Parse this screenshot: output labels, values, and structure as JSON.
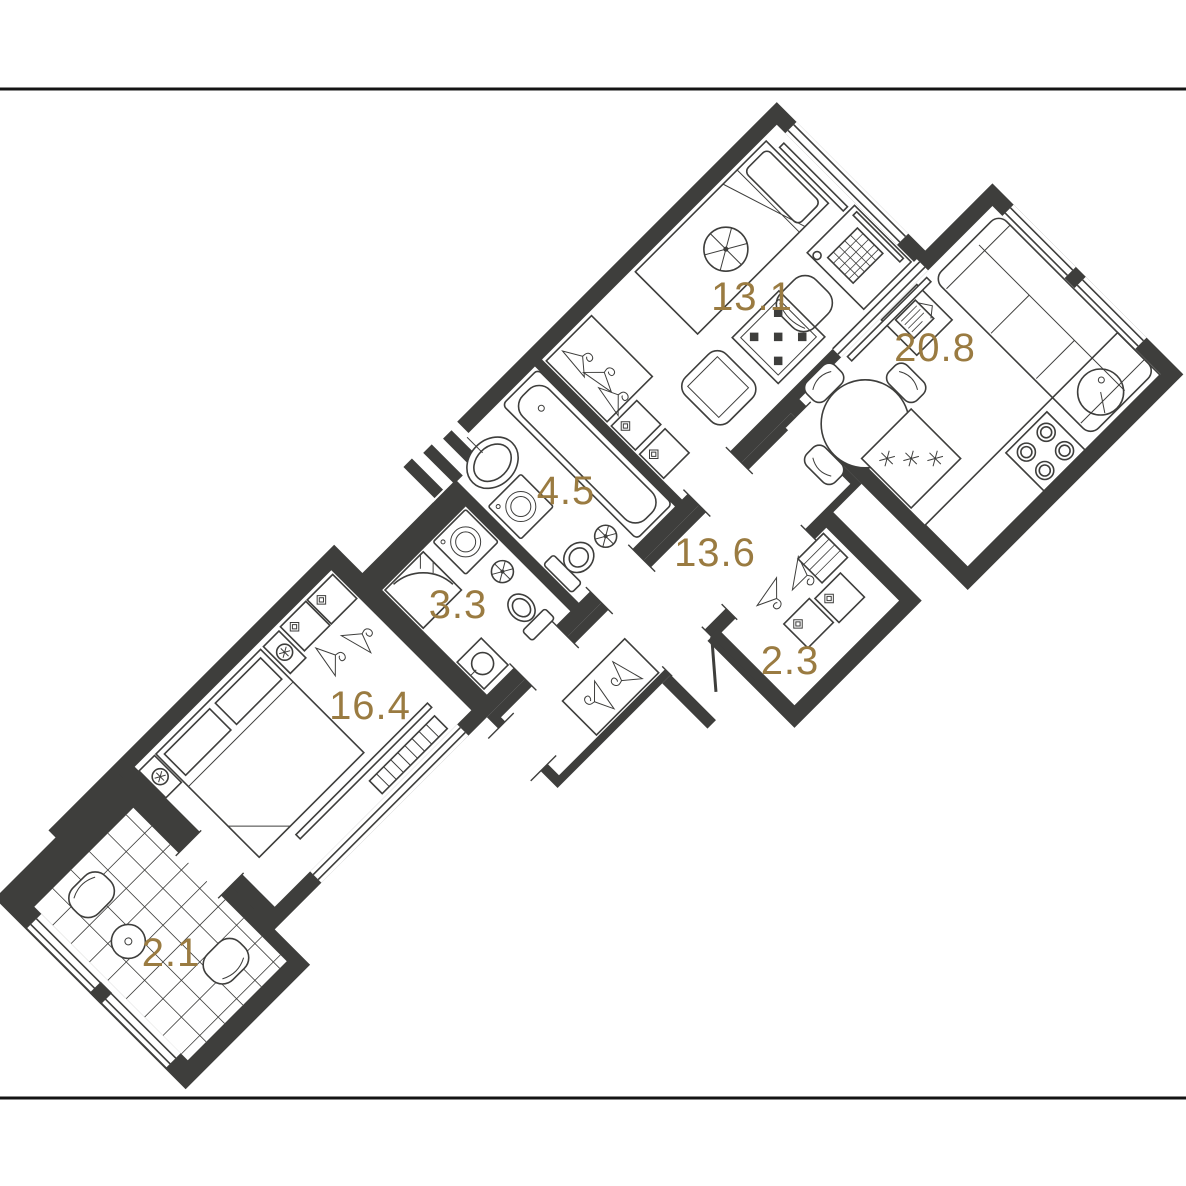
{
  "page": {
    "background": "#ffffff",
    "frame_lines": {
      "top_y": 89,
      "bottom_y": 1098,
      "color": "#141414"
    }
  },
  "colors": {
    "wall": "#3E3E3C",
    "label": "#9A7B41",
    "furniture_stroke": "#3E3E3C"
  },
  "plan": {
    "type": "apartment-floor-plan",
    "rotation_deg": -45,
    "rooms": [
      {
        "id": "bedroom-1",
        "area_label": "13.1",
        "furniture": [
          "bed",
          "pillow",
          "ceiling-light",
          "desk",
          "keyboard",
          "mouse",
          "monitor",
          "desk-chair",
          "armchair",
          "checkered-rug",
          "wardrobe-hangers",
          "drawer-boxes",
          "window"
        ]
      },
      {
        "id": "living-kitchen",
        "area_label": "20.8",
        "furniture": [
          "round-table",
          "dining-chairs",
          "sofa",
          "tv-papers",
          "fridge",
          "stove-burners",
          "kitchen-sink",
          "counter",
          "windows"
        ]
      },
      {
        "id": "bathroom",
        "area_label": "4.5",
        "furniture": [
          "bathtub",
          "oval-sink",
          "washing-machine",
          "toilet",
          "vent-fan"
        ]
      },
      {
        "id": "shower-room",
        "area_label": "3.3",
        "furniture": [
          "shower-cabin",
          "washing-machine",
          "sink",
          "toilet",
          "vent-fan"
        ]
      },
      {
        "id": "hallway",
        "area_label": "13.6",
        "furniture": [
          "coat-rack",
          "entrance-door"
        ]
      },
      {
        "id": "closet",
        "area_label": "2.3",
        "furniture": [
          "hangers",
          "drawer-boxes"
        ]
      },
      {
        "id": "bedroom-2",
        "area_label": "16.4",
        "furniture": [
          "double-bed",
          "nightstand-lamps",
          "wardrobe",
          "radiator",
          "window-sill",
          "window"
        ]
      },
      {
        "id": "balcony",
        "area_label": "2.1",
        "furniture": [
          "tiled-floor",
          "two-chairs",
          "small-table",
          "glazing"
        ]
      }
    ]
  }
}
